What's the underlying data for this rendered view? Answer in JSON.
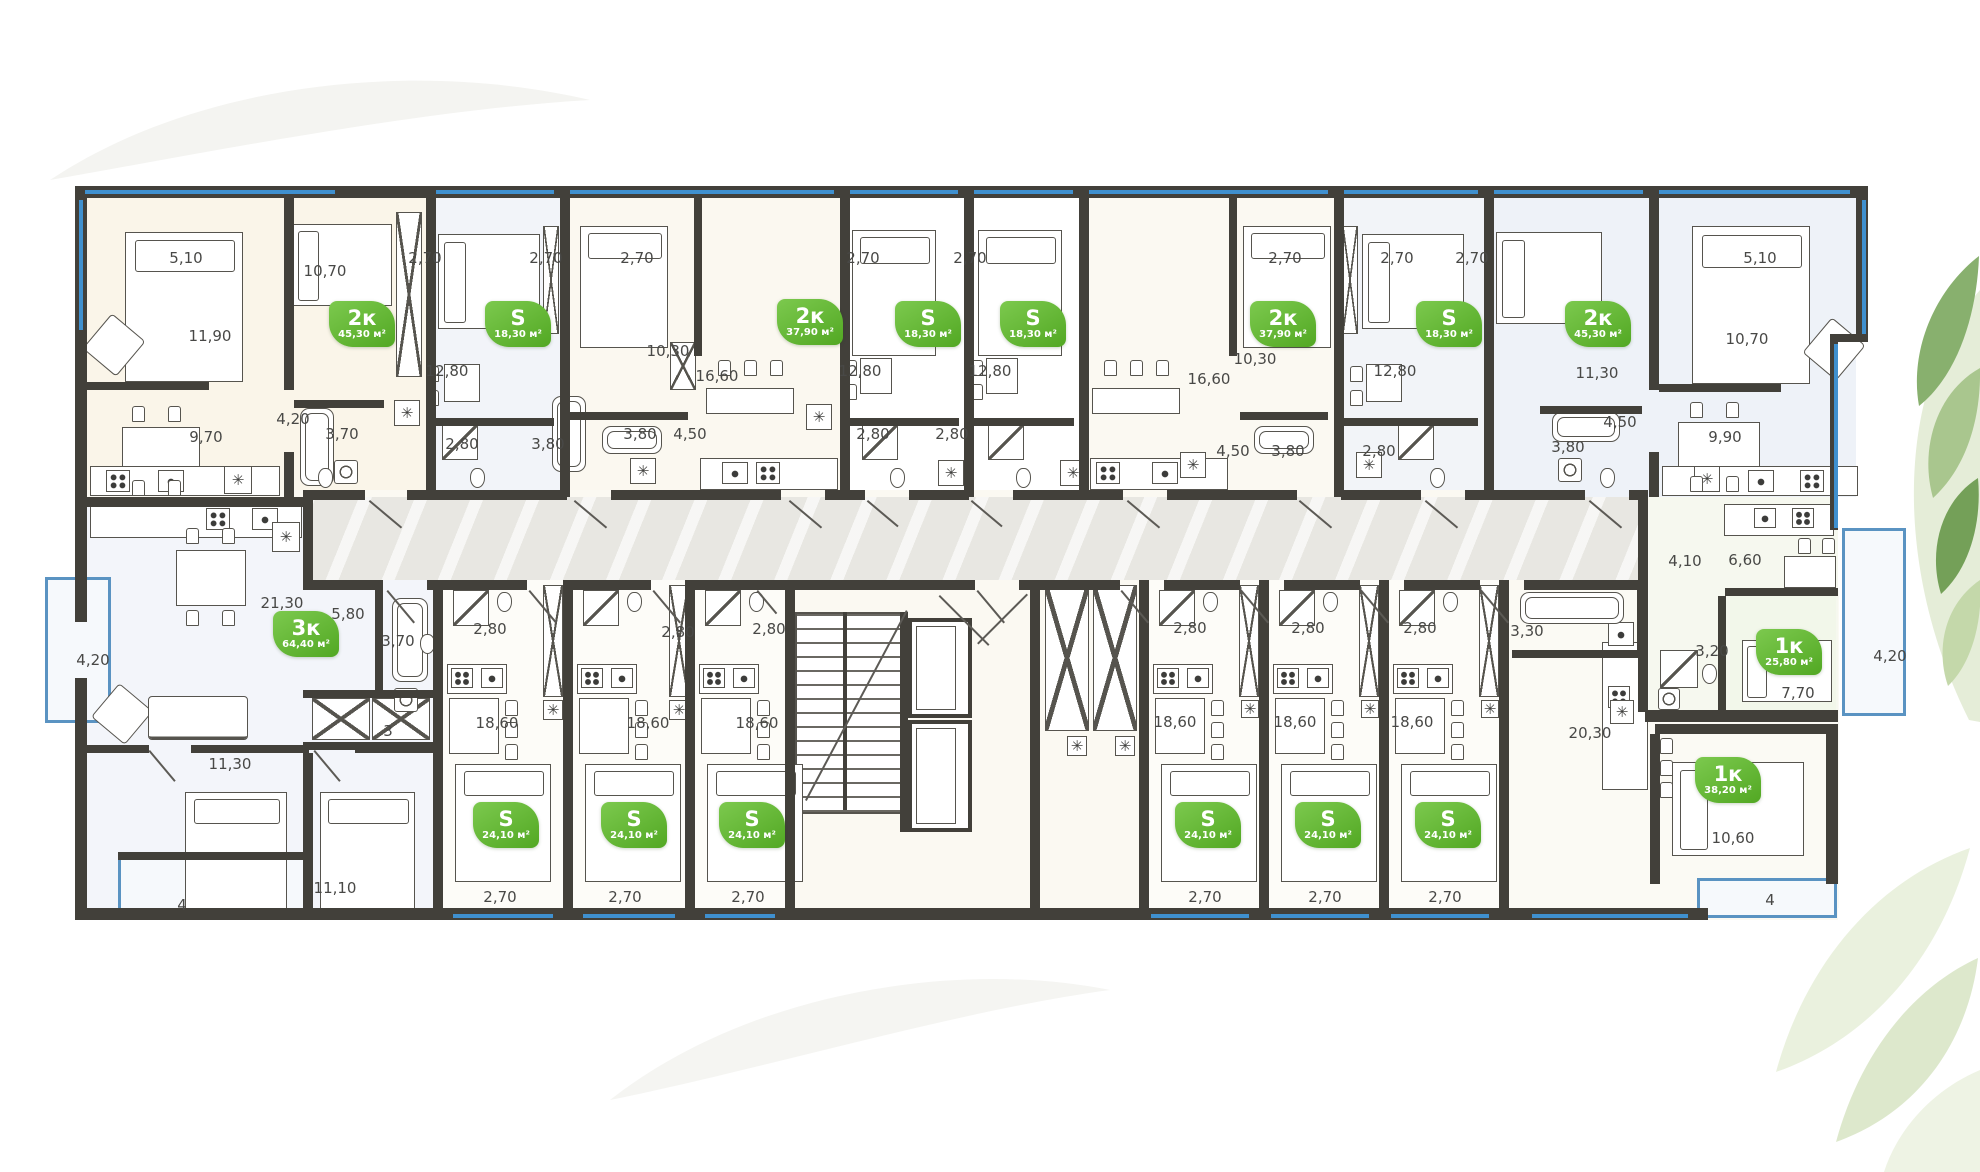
{
  "plan": {
    "badge_area_unit": "м²",
    "accent_green": "#5fb32c",
    "wall_color": "#42403a",
    "window_color": "#3f90cf"
  },
  "badges": [
    {
      "type": "2к",
      "area": "45,30 м²",
      "x": 362,
      "y": 324
    },
    {
      "type": "S",
      "area": "18,30 м²",
      "x": 518,
      "y": 324
    },
    {
      "type": "2к",
      "area": "37,90 м²",
      "x": 810,
      "y": 322
    },
    {
      "type": "S",
      "area": "18,30 м²",
      "x": 928,
      "y": 324
    },
    {
      "type": "S",
      "area": "18,30 м²",
      "x": 1033,
      "y": 324
    },
    {
      "type": "2к",
      "area": "37,90 м²",
      "x": 1283,
      "y": 324
    },
    {
      "type": "S",
      "area": "18,30 м²",
      "x": 1449,
      "y": 324
    },
    {
      "type": "2к",
      "area": "45,30 м²",
      "x": 1598,
      "y": 324
    },
    {
      "type": "3к",
      "area": "64,40 м²",
      "x": 306,
      "y": 634
    },
    {
      "type": "S",
      "area": "24,10 м²",
      "x": 506,
      "y": 825
    },
    {
      "type": "S",
      "area": "24,10 м²",
      "x": 634,
      "y": 825
    },
    {
      "type": "S",
      "area": "24,10 м²",
      "x": 752,
      "y": 825
    },
    {
      "type": "S",
      "area": "24,10 м²",
      "x": 1208,
      "y": 825
    },
    {
      "type": "S",
      "area": "24,10 м²",
      "x": 1328,
      "y": 825
    },
    {
      "type": "S",
      "area": "24,10 м²",
      "x": 1448,
      "y": 825
    },
    {
      "type": "1к",
      "area": "38,20 м²",
      "x": 1728,
      "y": 780
    },
    {
      "type": "1к",
      "area": "25,80 м²",
      "x": 1789,
      "y": 652
    }
  ],
  "dims": [
    {
      "t": "5,10",
      "x": 186,
      "y": 258
    },
    {
      "t": "2,70",
      "x": 425,
      "y": 258
    },
    {
      "t": "2,70",
      "x": 546,
      "y": 258
    },
    {
      "t": "2,70",
      "x": 637,
      "y": 258
    },
    {
      "t": "2,70",
      "x": 863,
      "y": 258
    },
    {
      "t": "2,70",
      "x": 970,
      "y": 258
    },
    {
      "t": "2,70",
      "x": 1285,
      "y": 258
    },
    {
      "t": "2,70",
      "x": 1397,
      "y": 258
    },
    {
      "t": "2,70",
      "x": 1472,
      "y": 258
    },
    {
      "t": "5,10",
      "x": 1760,
      "y": 258
    },
    {
      "t": "11,90",
      "x": 210,
      "y": 336
    },
    {
      "t": "10,70",
      "x": 325,
      "y": 271
    },
    {
      "t": "12,80",
      "x": 447,
      "y": 371
    },
    {
      "t": "10,30",
      "x": 668,
      "y": 351
    },
    {
      "t": "16,60",
      "x": 717,
      "y": 376
    },
    {
      "t": "12,80",
      "x": 860,
      "y": 371
    },
    {
      "t": "12,80",
      "x": 990,
      "y": 371
    },
    {
      "t": "16,60",
      "x": 1209,
      "y": 379
    },
    {
      "t": "10,30",
      "x": 1255,
      "y": 359
    },
    {
      "t": "12,80",
      "x": 1395,
      "y": 371
    },
    {
      "t": "11,30",
      "x": 1597,
      "y": 373
    },
    {
      "t": "10,70",
      "x": 1747,
      "y": 339
    },
    {
      "t": "9,70",
      "x": 206,
      "y": 437
    },
    {
      "t": "4,20",
      "x": 293,
      "y": 419
    },
    {
      "t": "3,70",
      "x": 342,
      "y": 434
    },
    {
      "t": "2,80",
      "x": 462,
      "y": 444
    },
    {
      "t": "3,80",
      "x": 548,
      "y": 444
    },
    {
      "t": "3,80",
      "x": 640,
      "y": 434
    },
    {
      "t": "4,50",
      "x": 690,
      "y": 434
    },
    {
      "t": "2,80",
      "x": 873,
      "y": 434
    },
    {
      "t": "2,80",
      "x": 952,
      "y": 434
    },
    {
      "t": "4,50",
      "x": 1233,
      "y": 451
    },
    {
      "t": "3,80",
      "x": 1288,
      "y": 451
    },
    {
      "t": "2,80",
      "x": 1379,
      "y": 451
    },
    {
      "t": "3,80",
      "x": 1568,
      "y": 447
    },
    {
      "t": "4,50",
      "x": 1620,
      "y": 422
    },
    {
      "t": "9,90",
      "x": 1725,
      "y": 437
    },
    {
      "t": "21,30",
      "x": 282,
      "y": 603
    },
    {
      "t": "5,80",
      "x": 348,
      "y": 614
    },
    {
      "t": "3,70",
      "x": 398,
      "y": 641
    },
    {
      "t": "4,20",
      "x": 93,
      "y": 660
    },
    {
      "t": "11,30",
      "x": 230,
      "y": 764
    },
    {
      "t": "3",
      "x": 388,
      "y": 731
    },
    {
      "t": "11,10",
      "x": 335,
      "y": 888
    },
    {
      "t": "4",
      "x": 182,
      "y": 905
    },
    {
      "t": "2,80",
      "x": 490,
      "y": 629
    },
    {
      "t": "2,80",
      "x": 678,
      "y": 632
    },
    {
      "t": "2,80",
      "x": 769,
      "y": 629
    },
    {
      "t": "18,60",
      "x": 497,
      "y": 723
    },
    {
      "t": "18,60",
      "x": 648,
      "y": 723
    },
    {
      "t": "18,60",
      "x": 757,
      "y": 723
    },
    {
      "t": "2,70",
      "x": 500,
      "y": 897
    },
    {
      "t": "2,70",
      "x": 625,
      "y": 897
    },
    {
      "t": "2,70",
      "x": 748,
      "y": 897
    },
    {
      "t": "2,80",
      "x": 1190,
      "y": 628
    },
    {
      "t": "2,80",
      "x": 1308,
      "y": 628
    },
    {
      "t": "2,80",
      "x": 1420,
      "y": 628
    },
    {
      "t": "3,30",
      "x": 1527,
      "y": 631
    },
    {
      "t": "18,60",
      "x": 1175,
      "y": 722
    },
    {
      "t": "18,60",
      "x": 1295,
      "y": 722
    },
    {
      "t": "18,60",
      "x": 1412,
      "y": 722
    },
    {
      "t": "2,70",
      "x": 1205,
      "y": 897
    },
    {
      "t": "2,70",
      "x": 1325,
      "y": 897
    },
    {
      "t": "2,70",
      "x": 1445,
      "y": 897
    },
    {
      "t": "20,30",
      "x": 1590,
      "y": 733
    },
    {
      "t": "10,60",
      "x": 1733,
      "y": 838
    },
    {
      "t": "4",
      "x": 1770,
      "y": 900
    },
    {
      "t": "3,20",
      "x": 1712,
      "y": 651
    },
    {
      "t": "7,70",
      "x": 1798,
      "y": 693
    },
    {
      "t": "4,20",
      "x": 1890,
      "y": 656
    },
    {
      "t": "4,10",
      "x": 1685,
      "y": 561
    },
    {
      "t": "6,60",
      "x": 1745,
      "y": 560
    }
  ],
  "icons": {
    "fridge_glyph": "✳"
  }
}
